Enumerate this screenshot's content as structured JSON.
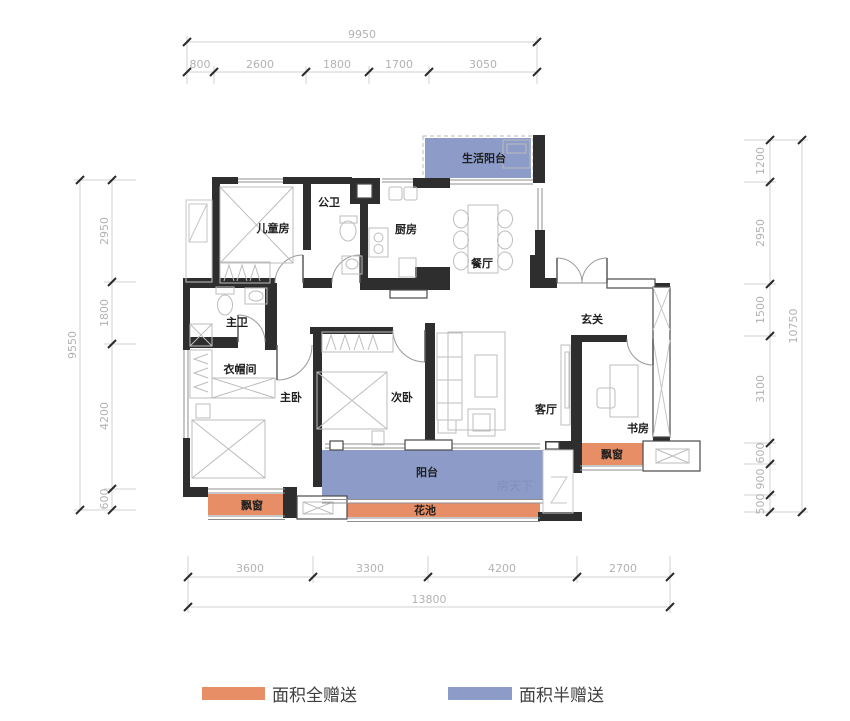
{
  "rooms": {
    "children_room": "儿童房",
    "public_bath": "公卫",
    "kitchen": "厨房",
    "dining": "餐厅",
    "life_balcony": "生活阳台",
    "entry": "玄关",
    "master_bath": "主卫",
    "cloakroom": "衣帽间",
    "master_bed": "主卧",
    "second_bed": "次卧",
    "living": "客厅",
    "study": "书房",
    "balcony": "阳台",
    "flower_bed": "花池",
    "bay_window_left": "飘窗",
    "bay_window_right": "飘窗"
  },
  "dimensions": {
    "top": {
      "total": "9950",
      "segments": [
        "800",
        "2600",
        "1800",
        "1700",
        "3050"
      ]
    },
    "bottom": {
      "total": "13800",
      "segments": [
        "3600",
        "3300",
        "4200",
        "2700"
      ]
    },
    "left": {
      "total": "9550",
      "segments": [
        "2950",
        "1800",
        "4200",
        "600"
      ]
    },
    "right": {
      "total": "10750",
      "segments": [
        "1200",
        "2950",
        "1500",
        "3100",
        "600",
        "900",
        "500"
      ]
    }
  },
  "legend": {
    "full_gift": {
      "label": "面积全赠送",
      "color": "#E88E66"
    },
    "half_gift": {
      "label": "面积半赠送",
      "color": "#8C9BC8"
    }
  },
  "watermark": "房天下",
  "colors": {
    "wall": "#2e2e2e",
    "full_gift_orange": "#E88E66",
    "half_gift_blue": "#8C9BC8"
  }
}
